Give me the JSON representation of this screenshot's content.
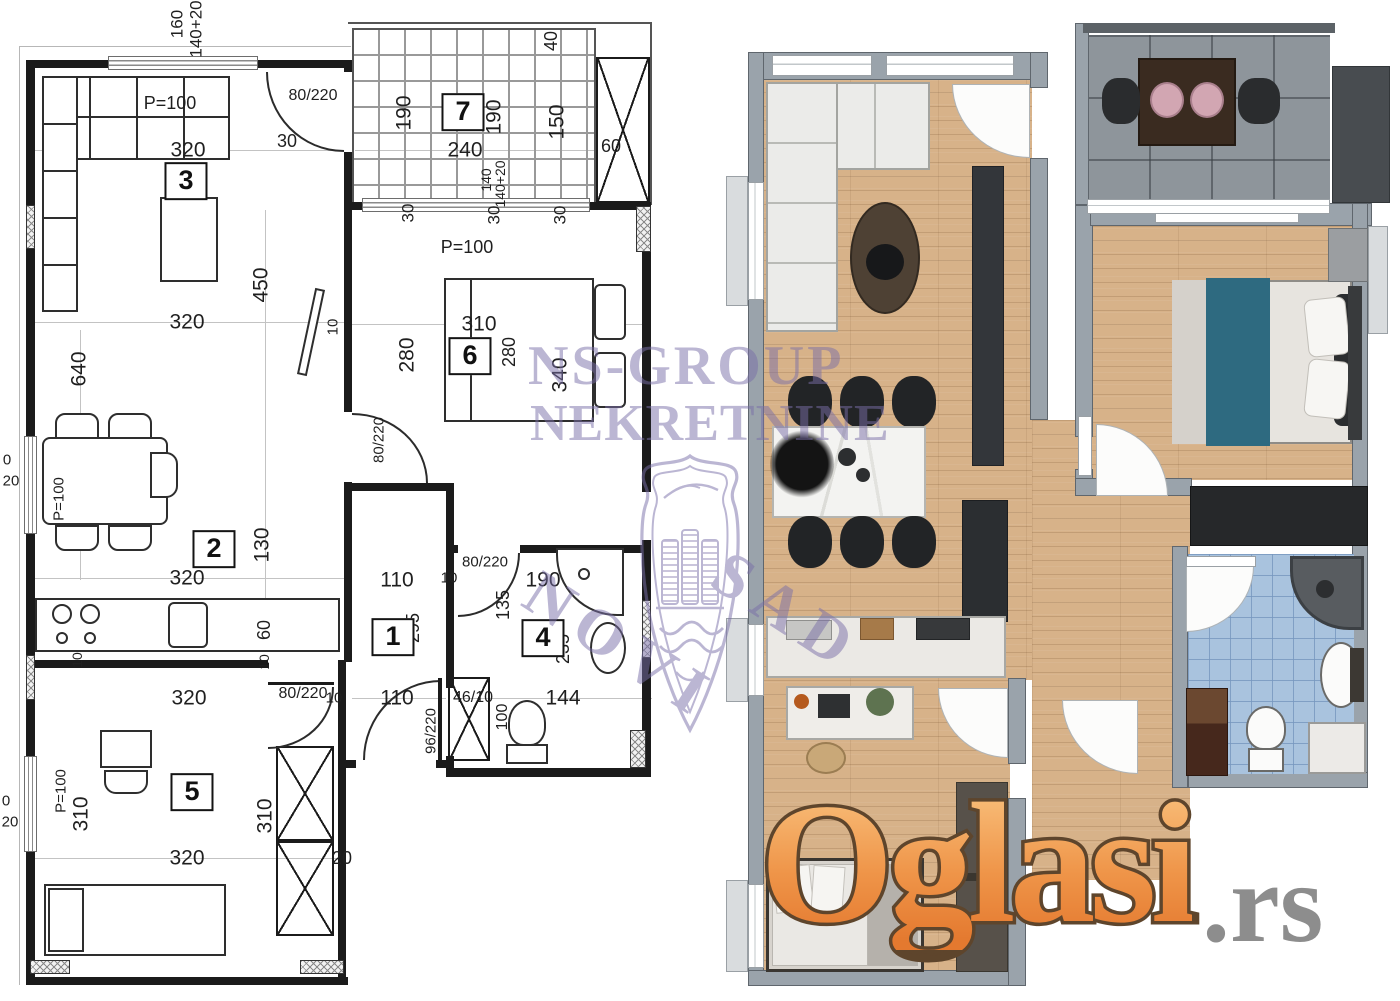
{
  "watermark": {
    "line1": "NS-GROUP",
    "line2": "NEKRETNINE",
    "diagonal_word1": "NOVI",
    "diagonal_word2": "SAD",
    "color": "#7a6fa8",
    "logo": "novi-sad-coat-of-arms-shield"
  },
  "brand": {
    "name": "Oglasi",
    "tld": ".rs",
    "orange": "#ef9549",
    "gray": "#8d8d8d"
  },
  "colors": {
    "wood_floor": "#d7b289",
    "terrace_tile": "#8e959b",
    "bathroom_tile": "#a9c3de",
    "wall_gray": "#9aa3ab",
    "bed_runner_teal": "#2e6a80",
    "plan_line": "#1b1b1b"
  },
  "left_plan": {
    "room_labels": [
      {
        "n": "1",
        "x": 393,
        "y": 637
      },
      {
        "n": "2",
        "x": 214,
        "y": 549
      },
      {
        "n": "3",
        "x": 186,
        "y": 181
      },
      {
        "n": "4",
        "x": 543,
        "y": 638
      },
      {
        "n": "5",
        "x": 192,
        "y": 792
      },
      {
        "n": "6",
        "x": 470,
        "y": 356
      },
      {
        "n": "7",
        "x": 463,
        "y": 112
      }
    ],
    "dim_labels": [
      {
        "t": "160",
        "x": 177,
        "y": 24,
        "r": 1,
        "s": 17
      },
      {
        "t": "140+20",
        "x": 196,
        "y": 29,
        "r": 1,
        "s": 17
      },
      {
        "t": "P=100",
        "x": 170,
        "y": 103,
        "s": 18
      },
      {
        "t": "320",
        "x": 188,
        "y": 150
      },
      {
        "t": "80/220",
        "x": 313,
        "y": 96,
        "s": 16
      },
      {
        "t": "30",
        "x": 287,
        "y": 141,
        "s": 18
      },
      {
        "t": "190",
        "x": 404,
        "y": 113,
        "r": 1
      },
      {
        "t": "190",
        "x": 494,
        "y": 117,
        "r": 1
      },
      {
        "t": "240",
        "x": 465,
        "y": 150
      },
      {
        "t": "40",
        "x": 551,
        "y": 41,
        "r": 1,
        "s": 18
      },
      {
        "t": "150",
        "x": 557,
        "y": 122,
        "r": 1
      },
      {
        "t": "60",
        "x": 611,
        "y": 146,
        "s": 18
      },
      {
        "t": "140",
        "x": 486,
        "y": 180,
        "r": 1,
        "s": 14
      },
      {
        "t": "140+20",
        "x": 500,
        "y": 184,
        "r": 1,
        "s": 14
      },
      {
        "t": "30",
        "x": 408,
        "y": 213,
        "r": 1,
        "s": 17
      },
      {
        "t": "30",
        "x": 494,
        "y": 215,
        "r": 1,
        "s": 17
      },
      {
        "t": "30",
        "x": 560,
        "y": 215,
        "r": 1,
        "s": 17
      },
      {
        "t": "P=100",
        "x": 467,
        "y": 247,
        "s": 18
      },
      {
        "t": "310",
        "x": 479,
        "y": 324
      },
      {
        "t": "280",
        "x": 407,
        "y": 355,
        "r": 1
      },
      {
        "t": "280",
        "x": 509,
        "y": 352,
        "r": 1,
        "s": 18
      },
      {
        "t": "340",
        "x": 560,
        "y": 375,
        "r": 1
      },
      {
        "t": "80/220",
        "x": 379,
        "y": 440,
        "r": 1,
        "s": 15
      },
      {
        "t": "450",
        "x": 261,
        "y": 285,
        "r": 1
      },
      {
        "t": "320",
        "x": 187,
        "y": 322
      },
      {
        "t": "640",
        "x": 79,
        "y": 369,
        "r": 1
      },
      {
        "t": "10",
        "x": 333,
        "y": 327,
        "r": 1,
        "s": 15
      },
      {
        "t": "P=100",
        "x": 59,
        "y": 499,
        "r": 1,
        "s": 15
      },
      {
        "t": "0",
        "x": 7,
        "y": 460,
        "s": 15
      },
      {
        "t": "20",
        "x": 11,
        "y": 481,
        "s": 15
      },
      {
        "t": "130",
        "x": 262,
        "y": 545,
        "r": 1
      },
      {
        "t": "320",
        "x": 187,
        "y": 578
      },
      {
        "t": "60",
        "x": 264,
        "y": 630,
        "r": 1,
        "s": 18
      },
      {
        "t": "10",
        "x": 77,
        "y": 660,
        "r": 1,
        "s": 14
      },
      {
        "t": "10",
        "x": 264,
        "y": 662,
        "r": 1,
        "s": 14
      },
      {
        "t": "320",
        "x": 189,
        "y": 698
      },
      {
        "t": "80/220",
        "x": 303,
        "y": 694,
        "s": 16
      },
      {
        "t": "10",
        "x": 334,
        "y": 698,
        "s": 15
      },
      {
        "t": "110",
        "x": 397,
        "y": 580
      },
      {
        "t": "10",
        "x": 449,
        "y": 578,
        "s": 15
      },
      {
        "t": "190",
        "x": 543,
        "y": 580
      },
      {
        "t": "80/220",
        "x": 485,
        "y": 562,
        "s": 15
      },
      {
        "t": "135",
        "x": 503,
        "y": 605,
        "r": 1,
        "s": 18
      },
      {
        "t": "295",
        "x": 413,
        "y": 628,
        "r": 1,
        "s": 18
      },
      {
        "t": "235",
        "x": 563,
        "y": 649,
        "r": 1,
        "s": 18
      },
      {
        "t": "110",
        "x": 397,
        "y": 698
      },
      {
        "t": "46/10",
        "x": 473,
        "y": 698,
        "s": 16
      },
      {
        "t": "144",
        "x": 563,
        "y": 698
      },
      {
        "t": "96/220",
        "x": 431,
        "y": 731,
        "r": 1,
        "s": 15
      },
      {
        "t": "100",
        "x": 503,
        "y": 717,
        "r": 1,
        "s": 16
      },
      {
        "t": "310",
        "x": 81,
        "y": 814,
        "r": 1
      },
      {
        "t": "310",
        "x": 265,
        "y": 816,
        "r": 1
      },
      {
        "t": "320",
        "x": 187,
        "y": 858
      },
      {
        "t": "20",
        "x": 342,
        "y": 858,
        "s": 18
      },
      {
        "t": "P=100",
        "x": 61,
        "y": 791,
        "r": 1,
        "s": 15
      },
      {
        "t": "0",
        "x": 6,
        "y": 801,
        "s": 15
      },
      {
        "t": "20",
        "x": 10,
        "y": 822,
        "s": 15
      }
    ]
  }
}
